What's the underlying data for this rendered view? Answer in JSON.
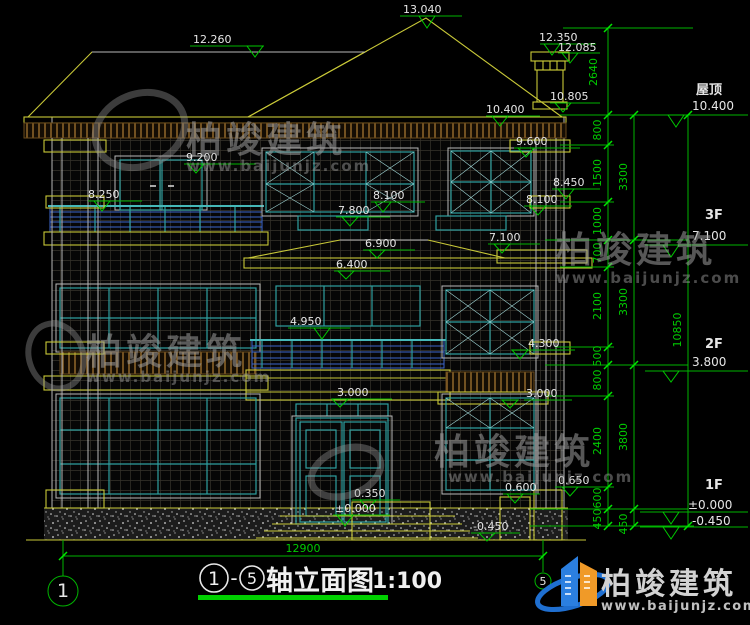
{
  "watermark": {
    "brand": "柏竣建筑",
    "site": "www.baijunjz.com"
  },
  "logo": {
    "brand": "柏竣建筑",
    "site": "www.baijunjz.com"
  },
  "title": {
    "bubble_start": "1",
    "dash": "-",
    "bubble_end": "5",
    "name": "轴立面图",
    "scale": "1:100"
  },
  "axis": {
    "left_bubble": "1",
    "right_bubble": "5"
  },
  "levels": {
    "roof_label": "屋顶",
    "roof_value": "10.400",
    "f3_label": "3F",
    "f3_value": "7.100",
    "f2_label": "2F",
    "f2_value": "3.800",
    "f1_label": "1F",
    "f1_zero": "±0.000",
    "f1_ground": "-0.450"
  },
  "elevations": {
    "peak": "13.040",
    "left_ridge": "12.260",
    "chimney_top": "12.350",
    "chimney_cap": "12.085",
    "chimney_base": "10.805",
    "roof_eave": "10.400",
    "eave_trim": "9.600",
    "f3_door_head": "9.200",
    "f3_rail_left": "8.250",
    "f3_rail_right": "8.450",
    "f3_win_head_center": "8.100",
    "f3_win_head_right": "8.100",
    "f3_transom": "7.800",
    "canopy_ridge": "6.900",
    "canopy_eave": "6.400",
    "f3_slab_right": "7.100",
    "f2_rail": "4.950",
    "f2_sill_right": "4.300",
    "f2_slab_center": "3.000",
    "f2_slab_right": "3.000",
    "entry_step": "0.350",
    "entry_floor": "±0.000",
    "ground": "-0.450",
    "pier_low": "0.600",
    "pier_high": "0.650"
  },
  "dims": {
    "top_height": "2640",
    "right_inner": [
      "800",
      "1500",
      "1000",
      "700",
      "2100",
      "500",
      "800",
      "2400",
      "600",
      "450"
    ],
    "right_outer": [
      "3300",
      "3300",
      "3800",
      "450"
    ],
    "total_height": "10850",
    "total_width": "12900"
  }
}
